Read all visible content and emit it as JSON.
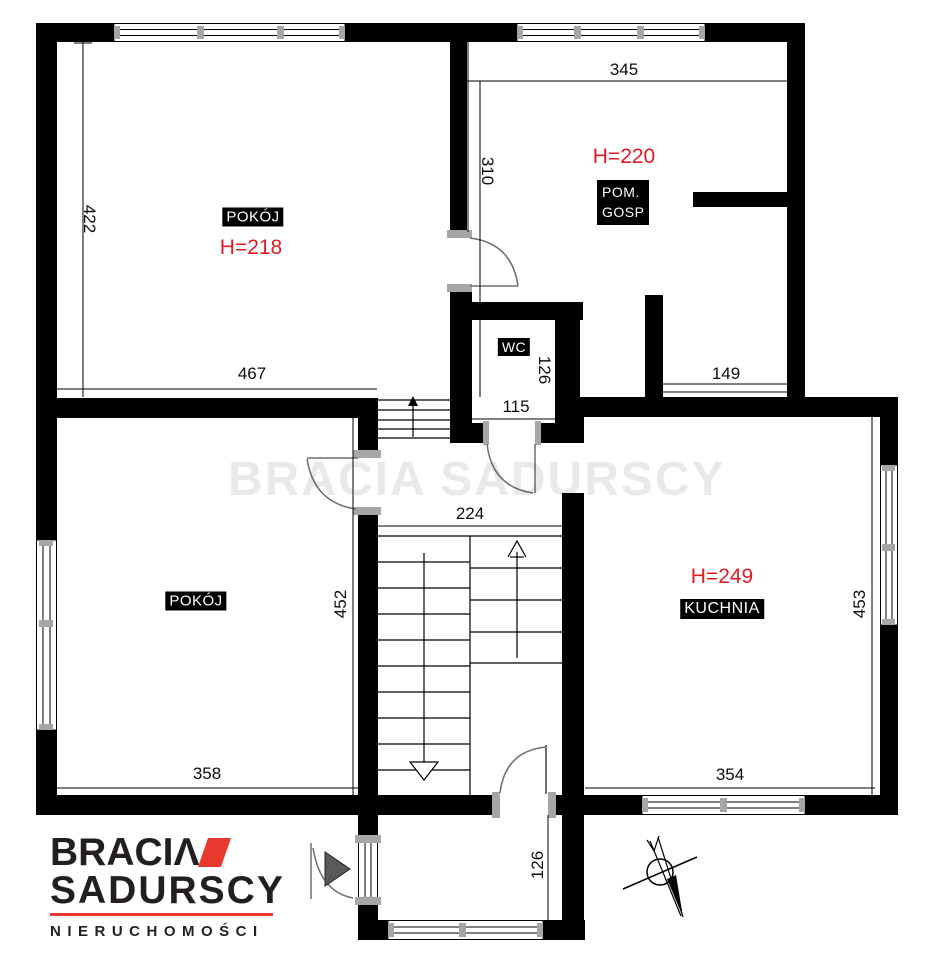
{
  "plan": {
    "rooms": {
      "room_top_left": {
        "label": "POKÓJ",
        "height_label": "H=218"
      },
      "utility": {
        "label_line1": "POM.",
        "label_line2": "GOSP",
        "height_label": "H=220"
      },
      "wc": {
        "label": "WC"
      },
      "room_bottom_left": {
        "label": "POKÓJ"
      },
      "kitchen": {
        "label": "KUCHNIA",
        "height_label": "H=249"
      }
    },
    "dims": {
      "d422": "422",
      "d467": "467",
      "d345": "345",
      "d310": "310",
      "d149": "149",
      "d115": "115",
      "d126_wc": "126",
      "d224": "224",
      "d452": "452",
      "d453": "453",
      "d358": "358",
      "d354": "354",
      "d126_vest": "126"
    },
    "colors": {
      "wall": "#000000",
      "dimension_red": "#e11b22",
      "logo_red": "#e8392e",
      "logo_dark": "#231f20",
      "label_bg": "#000000",
      "label_fg": "#ffffff"
    },
    "logo": {
      "word1": "BRACI",
      "word1_mark": "Λ",
      "word2": "SADURSCY",
      "tagline": "NIERUCHOMOŚCI"
    },
    "watermark": "BRACIA SADURSCY",
    "icons": [
      "north-arrow-icon",
      "entrance-arrow-icon",
      "stairs-up-arrow-icon",
      "stairs-down-arrow-icon"
    ]
  }
}
